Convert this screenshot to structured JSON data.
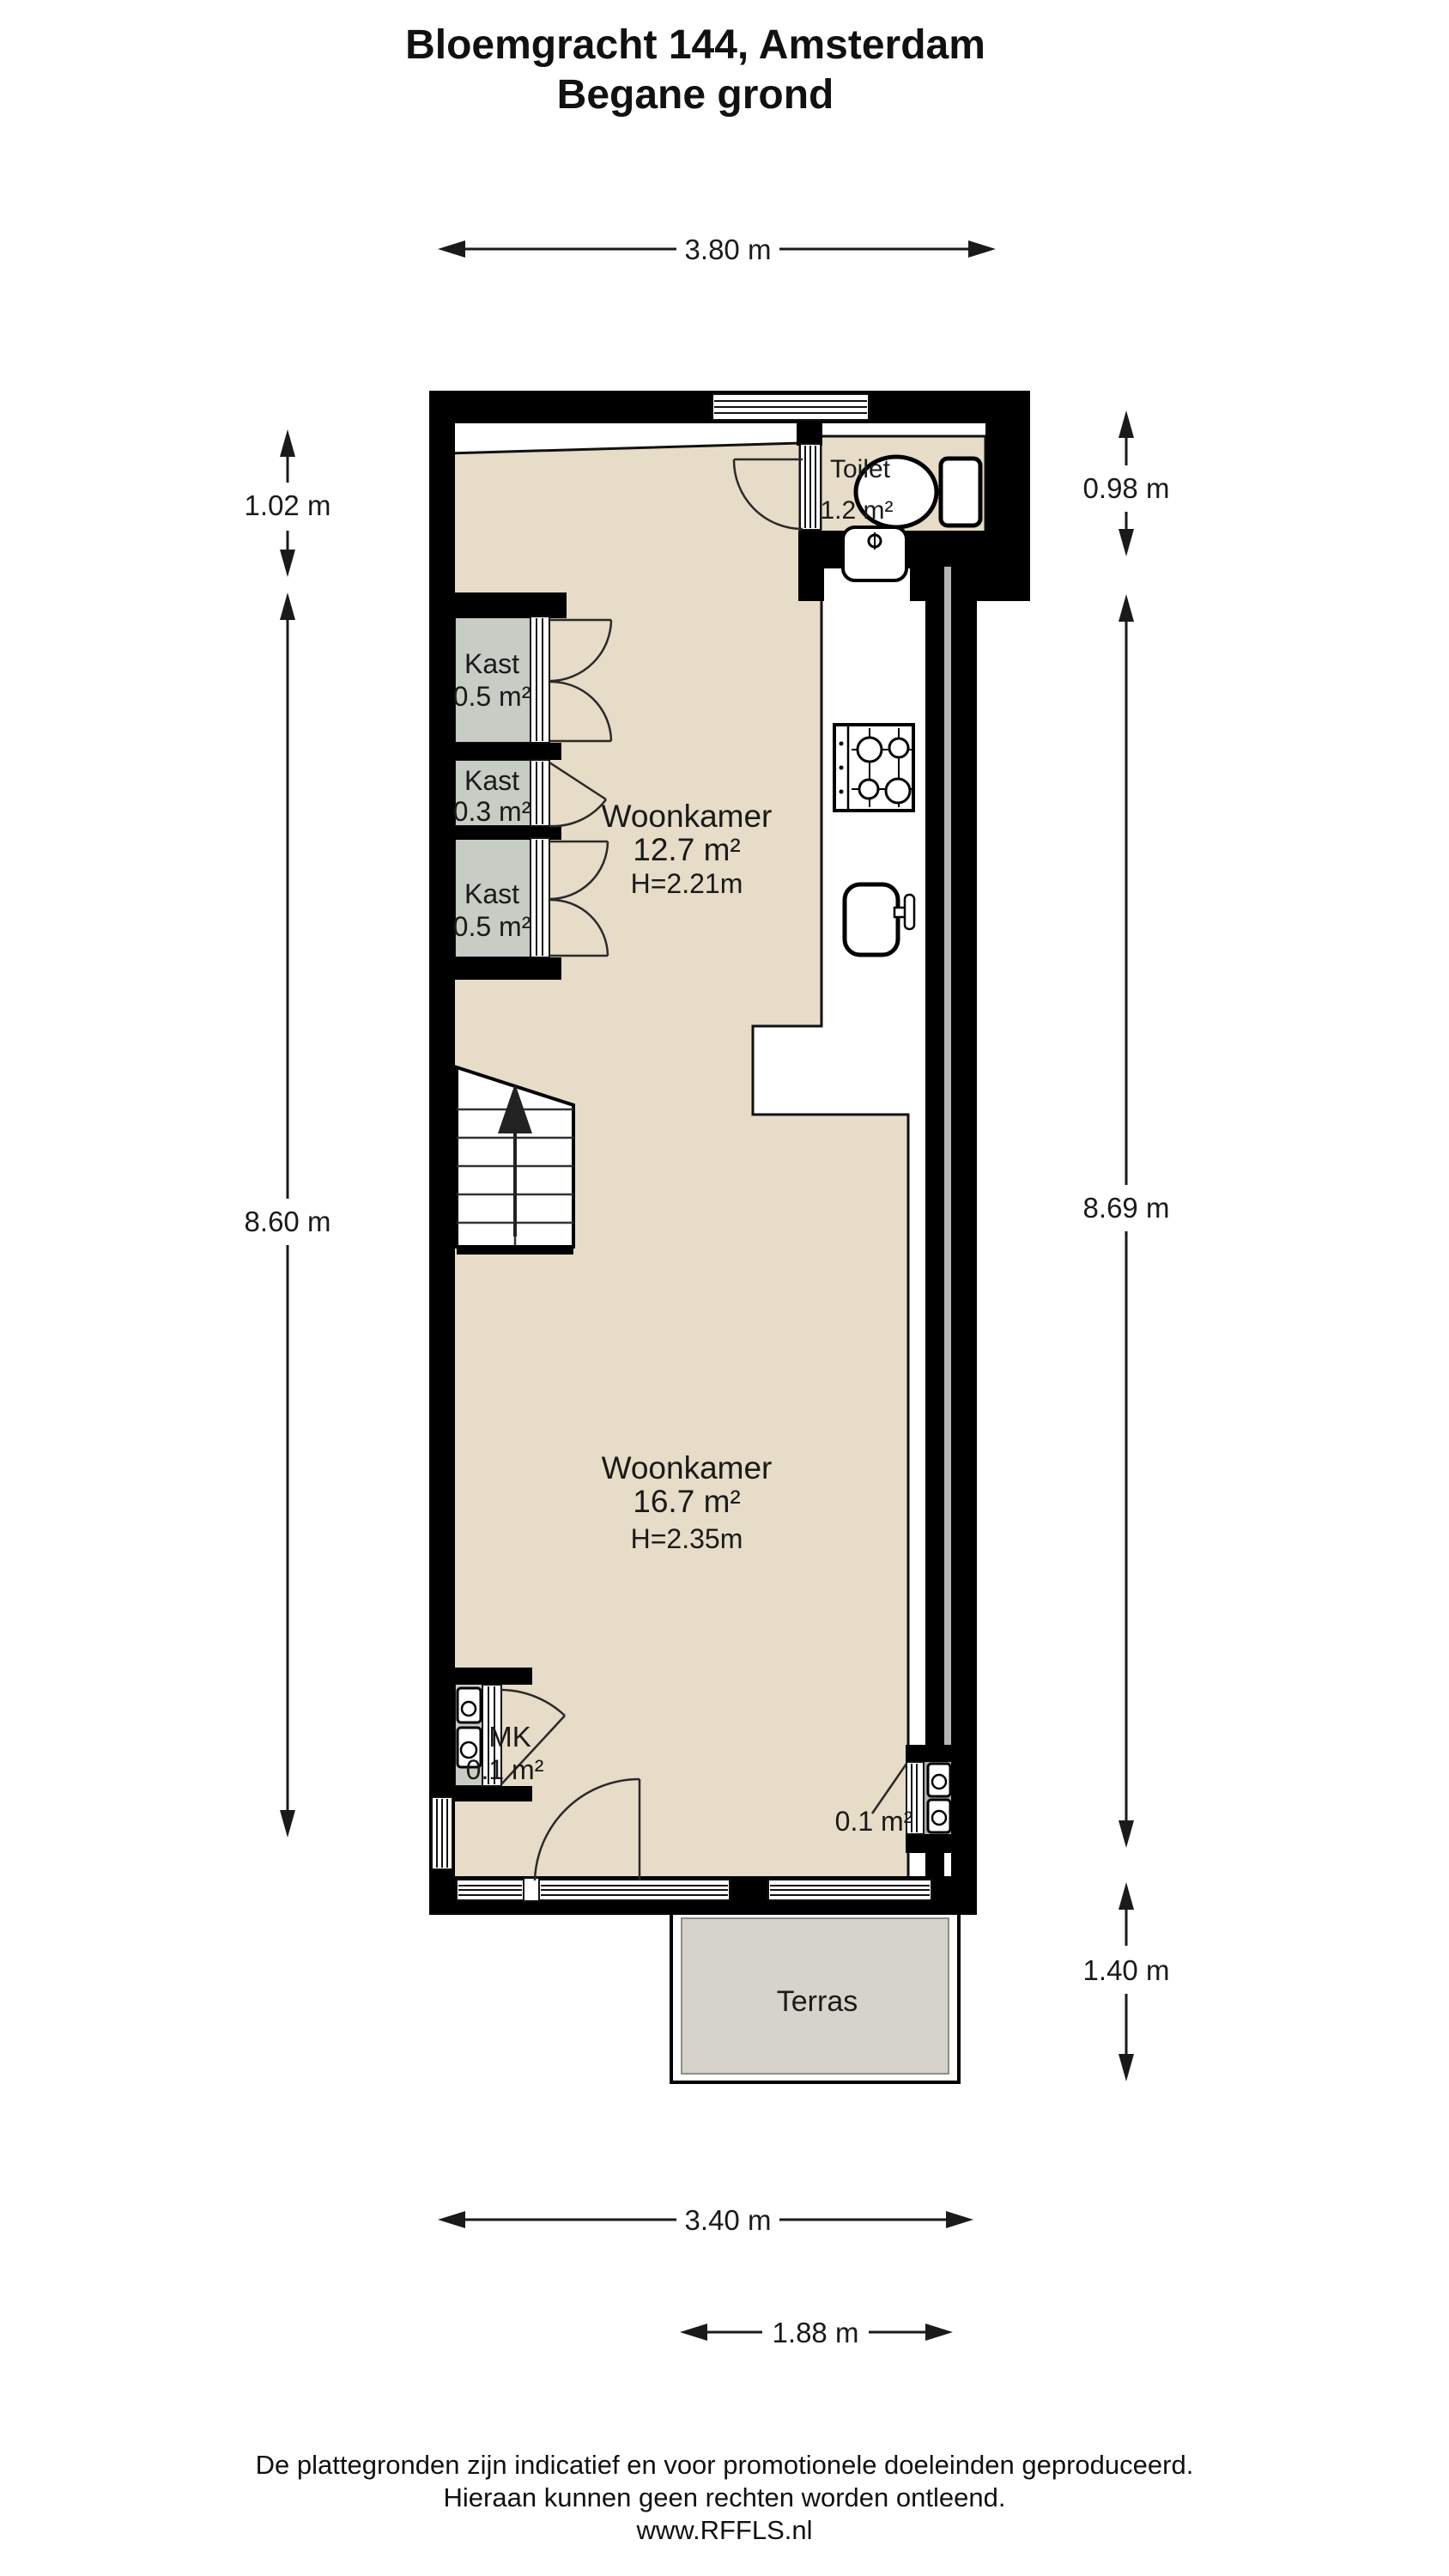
{
  "title": {
    "line1": "Bloemgracht 144, Amsterdam",
    "line2": "Begane grond"
  },
  "dimensions": {
    "top": "3.80 m",
    "left_upper": "1.02 m",
    "left_main": "8.60 m",
    "right_upper": "0.98 m",
    "right_main": "8.69 m",
    "right_terrace": "1.40 m",
    "bottom_main": "3.40 m",
    "bottom_terrace": "1.88 m"
  },
  "rooms": {
    "toilet": {
      "name": "Toilet",
      "area": "1.2 m²"
    },
    "kast1": {
      "name": "Kast",
      "area": "0.5 m²"
    },
    "kast2": {
      "name": "Kast",
      "area": "0.3 m²"
    },
    "kast3": {
      "name": "Kast",
      "area": "0.5 m²"
    },
    "woonkamer_front": {
      "name": "Woonkamer",
      "area": "12.7 m²",
      "height": "H=2.21m"
    },
    "woonkamer_back": {
      "name": "Woonkamer",
      "area": "16.7 m²",
      "height": "H=2.35m"
    },
    "mk": {
      "name": "MK",
      "area": "0.1 m²"
    },
    "meter_closet_right": {
      "area": "0.1 m²"
    },
    "terras": {
      "name": "Terras"
    }
  },
  "footer": {
    "line1": "De plattegronden zijn indicatief en voor promotionele doeleinden geproduceerd.",
    "line2": "Hieraan kunnen geen rechten worden ontleend.",
    "line3": "www.RFFLS.nl"
  },
  "colors": {
    "floor": "#e6dcc7",
    "closet": "#c7ccc4",
    "terrace": "#d5d3ca",
    "meter_closet": "#aeaeab",
    "wall": "#000000"
  }
}
